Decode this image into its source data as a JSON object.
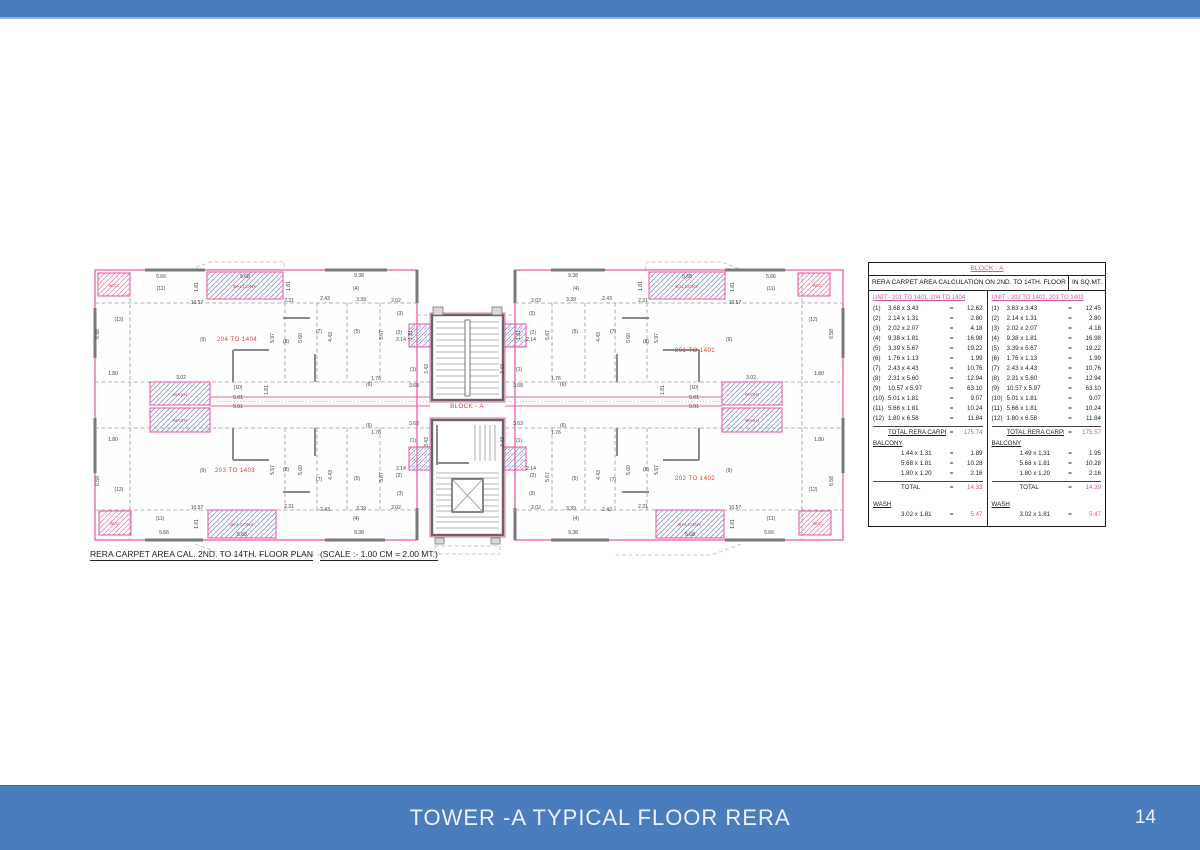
{
  "colors": {
    "blue": "#4a7dbd",
    "pink": "#cb5a9e",
    "planpink": "#ef5da8",
    "red": "#e23b3b"
  },
  "page": {
    "number": "14"
  },
  "footer": {
    "title": "TOWER -A TYPICAL FLOOR RERA"
  },
  "caption": {
    "text": "RERA CARPET AREA CAL. 2ND. TO 14TH. FLOOR PLAN",
    "scale": "(SCALE :- 1.00 CM = 2.00 MT.)"
  },
  "table": {
    "block_header": "BLOCK - A",
    "title": "RERA CARPET AREA CALCULATION ON 2ND. TO 14TH. FLOOR",
    "unit_suffix": "IN SQ.MT.",
    "eq": "=",
    "units": [
      {
        "header": "UNIT - 201 TO 1401, 204 TO 1404",
        "items": [
          [
            "(1)",
            "3.68 x 3.43",
            "12.62"
          ],
          [
            "(2)",
            "2.14 x 1.31",
            "2.80"
          ],
          [
            "(3)",
            "2.02 x 2.07",
            "4.18"
          ],
          [
            "(4)",
            "9.38 x 1.81",
            "16.98"
          ],
          [
            "(5)",
            "3.39 x 5.67",
            "19.22"
          ],
          [
            "(6)",
            "1.76 x 1.13",
            "1.99"
          ],
          [
            "(7)",
            "2.43 x 4.43",
            "10.76"
          ],
          [
            "(8)",
            "2.31 x 5.60",
            "12.94"
          ],
          [
            "(9)",
            "10.57 x 5.97",
            "63.10"
          ],
          [
            "(10)",
            "5.01 x 1.81",
            "9.07"
          ],
          [
            "(11)",
            "5.66 x 1.81",
            "10.24"
          ],
          [
            "(12)",
            "1.80 x 6.58",
            "11.84"
          ]
        ],
        "total_label": "TOTAL RERA CARPET",
        "total": "175.74",
        "balcony_label": "BALCONY",
        "balcony_items": [
          [
            "1.44 x 1.31",
            "1.89"
          ],
          [
            "5.68 x 1.81",
            "10.28"
          ],
          [
            "1.80 x 1.20",
            "2.16"
          ]
        ],
        "balcony_total_label": "TOTAL",
        "balcony_total": "14.33",
        "wash_label": "WASH",
        "wash_items": [
          [
            "3.02 x 1.81",
            "5.47"
          ]
        ]
      },
      {
        "header": "UNIT - 202 TO 1402, 203 TO 1403",
        "items": [
          [
            "(1)",
            "3.63 x 3.43",
            "12.45"
          ],
          [
            "(2)",
            "2.14 x 1.31",
            "2.80"
          ],
          [
            "(3)",
            "2.02 x 2.07",
            "4.18"
          ],
          [
            "(4)",
            "9.38 x 1.81",
            "16.98"
          ],
          [
            "(5)",
            "3.39 x 5.67",
            "19.22"
          ],
          [
            "(6)",
            "1.76 x 1.13",
            "1.99"
          ],
          [
            "(7)",
            "2.43 x 4.43",
            "10.76"
          ],
          [
            "(8)",
            "2.31 x 5.60",
            "12.94"
          ],
          [
            "(9)",
            "10.57 x 5.97",
            "63.10"
          ],
          [
            "(10)",
            "5.01 x 1.81",
            "9.07"
          ],
          [
            "(11)",
            "5.66 x 1.81",
            "10.24"
          ],
          [
            "(12)",
            "1.80 x 6.58",
            "11.84"
          ]
        ],
        "total_label": "TOTAL RERA CARPET",
        "total": "175.57",
        "balcony_label": "BALCONY",
        "balcony_items": [
          [
            "1.49 x 1.31",
            "1.95"
          ],
          [
            "5.68 x 1.81",
            "10.28"
          ],
          [
            "1.80 x 1.20",
            "2.16"
          ]
        ],
        "balcony_total_label": "TOTAL",
        "balcony_total": "14.39",
        "wash_label": "WASH",
        "wash_items": [
          [
            "3.02 x 1.81",
            "5.47"
          ]
        ]
      }
    ]
  },
  "plan": {
    "labels": [
      [
        "5.66",
        76,
        20
      ],
      [
        "(11)",
        76,
        32
      ],
      [
        "1.81",
        113,
        29,
        "v"
      ],
      [
        "5.68",
        160,
        20
      ],
      [
        "BALCONY",
        160,
        30,
        "r"
      ],
      [
        "1.81",
        205,
        28,
        "v"
      ],
      [
        "10.57",
        112,
        46
      ],
      [
        "2.31",
        204,
        44
      ],
      [
        "2.43",
        240,
        42
      ],
      [
        "9.38",
        274,
        19
      ],
      [
        "(4)",
        271,
        32
      ],
      [
        "3.39",
        276,
        43
      ],
      [
        "2.02",
        311,
        44
      ],
      [
        "(3)",
        315,
        57
      ],
      [
        "(12)",
        34,
        63
      ],
      [
        "6.58",
        14,
        76,
        "v"
      ],
      [
        "W.C.",
        29,
        29,
        "r"
      ],
      [
        "204 TO 1404",
        152,
        83,
        "u"
      ],
      [
        "(9)",
        118,
        83
      ],
      [
        "5.97",
        189,
        80,
        "v"
      ],
      [
        "(8)",
        201,
        85
      ],
      [
        "5.60",
        217,
        80,
        "v"
      ],
      [
        "(7)",
        234,
        75
      ],
      [
        "4.43",
        247,
        79,
        "v"
      ],
      [
        "(5)",
        272,
        75
      ],
      [
        "5.67",
        298,
        77,
        "v"
      ],
      [
        "(2)",
        314,
        76
      ],
      [
        "2.14",
        316,
        83
      ],
      [
        "1.31",
        327,
        77,
        "v"
      ],
      [
        "1.80",
        28,
        117
      ],
      [
        "(6)",
        284,
        128
      ],
      [
        "1.76",
        291,
        122
      ],
      [
        "(1)",
        328,
        113
      ],
      [
        "3.43",
        343,
        111,
        "v"
      ],
      [
        "3.68",
        329,
        129
      ],
      [
        "WASH",
        95,
        138,
        "r"
      ],
      [
        "WASH",
        95,
        164,
        "r"
      ],
      [
        "3.02",
        96,
        121
      ],
      [
        "(10)",
        153,
        131
      ],
      [
        "5.01",
        153,
        141
      ],
      [
        "5.01",
        153,
        150
      ],
      [
        "1.81",
        183,
        132,
        "v"
      ],
      [
        "1.80",
        28,
        183
      ],
      [
        "(12)",
        34,
        233
      ],
      [
        "6.58",
        14,
        223,
        "v"
      ],
      [
        "(9)",
        118,
        214
      ],
      [
        "203 TO 1403",
        150,
        214,
        "u"
      ],
      [
        "5.97",
        189,
        212,
        "v"
      ],
      [
        "(8)",
        201,
        213
      ],
      [
        "5.60",
        217,
        212,
        "v"
      ],
      [
        "(7)",
        234,
        223
      ],
      [
        "4.43",
        247,
        217,
        "v"
      ],
      [
        "(5)",
        272,
        222
      ],
      [
        "5.67",
        298,
        219,
        "v"
      ],
      [
        "(2)",
        314,
        219
      ],
      [
        "2.14",
        316,
        212
      ],
      [
        "(3)",
        315,
        237
      ],
      [
        "2.02",
        311,
        251
      ],
      [
        "3.39",
        276,
        252
      ],
      [
        "(4)",
        271,
        262
      ],
      [
        "9.38",
        274,
        276
      ],
      [
        "(6)",
        284,
        169
      ],
      [
        "1.76",
        291,
        176
      ],
      [
        "(1)",
        328,
        184
      ],
      [
        "3.43",
        343,
        184,
        "v"
      ],
      [
        "3.63",
        329,
        167
      ],
      [
        "10.57",
        112,
        251
      ],
      [
        "2.31",
        204,
        250
      ],
      [
        "2.43",
        240,
        253
      ],
      [
        "(11)",
        75,
        262
      ],
      [
        "5.66",
        79,
        276
      ],
      [
        "1.81",
        113,
        266,
        "v"
      ],
      [
        "BALCONY",
        157,
        268,
        "r"
      ],
      [
        "5.68",
        157,
        278
      ],
      [
        "W.C.",
        30,
        267,
        "r"
      ],
      [
        "BLOCK - A",
        382,
        150,
        "u"
      ],
      [
        "5.66",
        686,
        20
      ],
      [
        "(11)",
        686,
        32
      ],
      [
        "1.81",
        649,
        29,
        "v"
      ],
      [
        "5.68",
        602,
        20
      ],
      [
        "BALCONY",
        602,
        30,
        "r"
      ],
      [
        "1.81",
        557,
        28,
        "v"
      ],
      [
        "10.57",
        650,
        46
      ],
      [
        "2.31",
        558,
        44
      ],
      [
        "2.43",
        522,
        42
      ],
      [
        "9.38",
        488,
        19
      ],
      [
        "(4)",
        491,
        32
      ],
      [
        "3.39",
        486,
        43
      ],
      [
        "2.02",
        451,
        44
      ],
      [
        "(3)",
        447,
        57
      ],
      [
        "(12)",
        728,
        63
      ],
      [
        "6.58",
        748,
        76,
        "v"
      ],
      [
        "W.C.",
        733,
        29,
        "r"
      ],
      [
        "201 TO 1401",
        610,
        94,
        "u"
      ],
      [
        "(9)",
        644,
        83
      ],
      [
        "5.97",
        573,
        80,
        "v"
      ],
      [
        "(8)",
        561,
        85
      ],
      [
        "5.60",
        545,
        80,
        "v"
      ],
      [
        "(7)",
        528,
        75
      ],
      [
        "4.43",
        515,
        79,
        "v"
      ],
      [
        "(5)",
        490,
        75
      ],
      [
        "5.67",
        464,
        77,
        "v"
      ],
      [
        "(2)",
        448,
        76
      ],
      [
        "2.14",
        446,
        83
      ],
      [
        "1.31",
        435,
        77,
        "v"
      ],
      [
        "1.80",
        734,
        117
      ],
      [
        "(6)",
        478,
        128
      ],
      [
        "1.76",
        471,
        122
      ],
      [
        "(1)",
        434,
        113
      ],
      [
        "3.43",
        419,
        111,
        "v"
      ],
      [
        "3.68",
        433,
        129
      ],
      [
        "WASH",
        667,
        138,
        "r"
      ],
      [
        "WASH",
        667,
        164,
        "r"
      ],
      [
        "3.02",
        666,
        121
      ],
      [
        "(10)",
        609,
        131
      ],
      [
        "5.01",
        609,
        141
      ],
      [
        "5.01",
        609,
        150
      ],
      [
        "1.81",
        579,
        132,
        "v"
      ],
      [
        "1.80",
        734,
        183
      ],
      [
        "(12)",
        728,
        233
      ],
      [
        "6.58",
        748,
        223,
        "v"
      ],
      [
        "(9)",
        644,
        214
      ],
      [
        "202 TO 1402",
        610,
        222,
        "u"
      ],
      [
        "5.97",
        573,
        212,
        "v"
      ],
      [
        "(8)",
        561,
        213
      ],
      [
        "5.60",
        545,
        212,
        "v"
      ],
      [
        "(7)",
        528,
        223
      ],
      [
        "4.43",
        515,
        217,
        "v"
      ],
      [
        "(5)",
        490,
        222
      ],
      [
        "5.67",
        464,
        219,
        "v"
      ],
      [
        "(2)",
        448,
        219
      ],
      [
        "2.14",
        446,
        212
      ],
      [
        "(3)",
        447,
        237
      ],
      [
        "2.02",
        451,
        251
      ],
      [
        "3.39",
        486,
        252
      ],
      [
        "(4)",
        491,
        262
      ],
      [
        "9.38",
        488,
        276
      ],
      [
        "(6)",
        478,
        169
      ],
      [
        "1.76",
        471,
        176
      ],
      [
        "(1)",
        434,
        184
      ],
      [
        "3.43",
        419,
        184,
        "v"
      ],
      [
        "3.63",
        433,
        167
      ],
      [
        "10.57",
        650,
        251
      ],
      [
        "2.31",
        558,
        250
      ],
      [
        "2.43",
        522,
        253
      ],
      [
        "(11)",
        686,
        262
      ],
      [
        "5.66",
        684,
        276
      ],
      [
        "1.81",
        649,
        266,
        "v"
      ],
      [
        "BALCONY",
        605,
        268,
        "r"
      ],
      [
        "5.68",
        605,
        278
      ],
      [
        "W.C.",
        733,
        267,
        "r"
      ]
    ]
  }
}
